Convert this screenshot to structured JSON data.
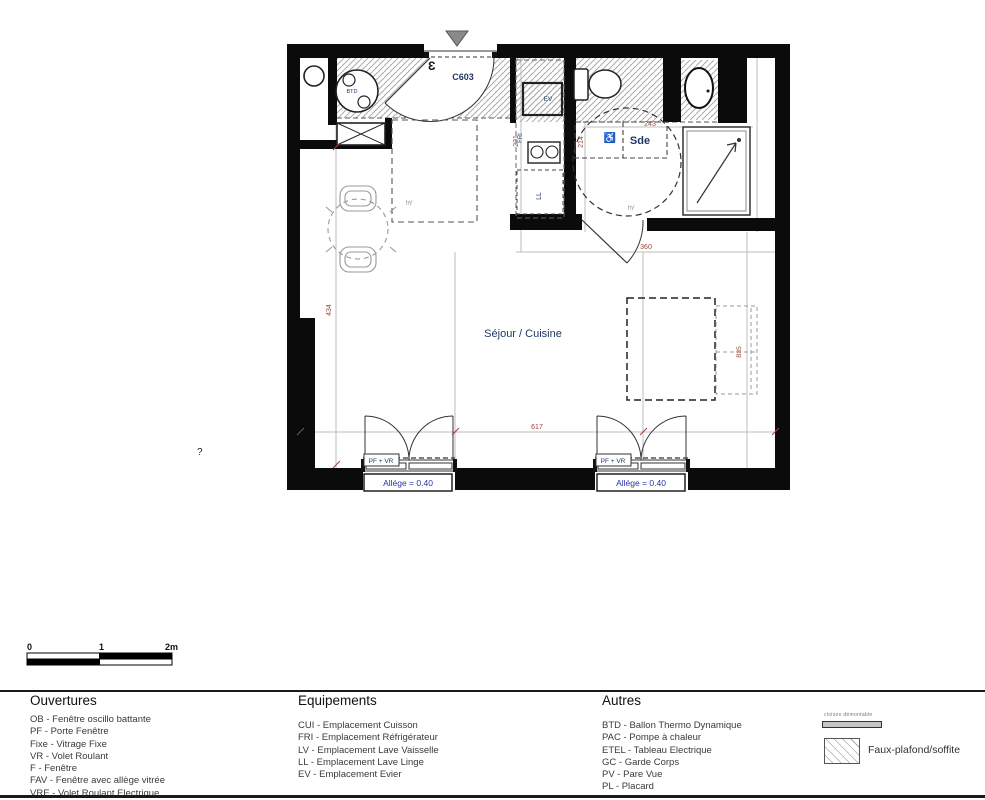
{
  "plan": {
    "unit": "C603",
    "entrance_mark": "Ɛ",
    "rooms": {
      "sde": "Sde",
      "sejour": "Séjour / Cuisine"
    },
    "equipment": {
      "btd": "BTD",
      "ev": "EV",
      "fri": "FRI",
      "ll": "LL"
    },
    "dims": {
      "kitchen_depth": "221",
      "sde_depth": "214",
      "sde_width": "243",
      "sde_opening": "360",
      "living_height": "434",
      "living_width": "617",
      "bed_side": "B35"
    },
    "window_tag": "PF + VR",
    "allege": "Allége = 0.40",
    "accessibility": "♿",
    "note_glyph": "hy",
    "question_mark": "?"
  },
  "scalebar": {
    "zero": "0",
    "one": "1",
    "two": "2m"
  },
  "legend": {
    "ouvertures": {
      "title": "Ouvertures",
      "items": [
        "OB - Fenêtre oscillo battante",
        "PF - Porte Fenêtre",
        "Fixe - Vitrage Fixe",
        "VR - Volet Roulant",
        "F - Fenêtre",
        "FAV - Fenêtre avec allège vitrée",
        "VRE - Volet Roulant Electrique"
      ]
    },
    "equipements": {
      "title": "Equipements",
      "items": [
        "CUI - Emplacement Cuisson",
        "FRI - Emplacement Réfrigérateur",
        "LV - Emplacement Lave Vaisselle",
        "LL - Emplacement Lave Linge",
        "EV - Emplacement Evier"
      ]
    },
    "autres": {
      "title": "Autres",
      "items": [
        "BTD - Ballon Thermo Dynamique",
        "PAC - Pompe à chaleur",
        "ETEL - Tableau Electrique",
        "GC - Garde Corps",
        "PV - Pare Vue",
        "PL - Placard"
      ]
    },
    "symbols": {
      "cloison": "cloison démontable",
      "faux_plafond": "Faux-plafond/soffite"
    }
  },
  "colors": {
    "wall": "#0b0b0b",
    "label_navy": "#1f3864",
    "dim_red": "#9a463a",
    "allege_blue": "#2433a8",
    "hatch_gray": "#aaaaaa"
  }
}
